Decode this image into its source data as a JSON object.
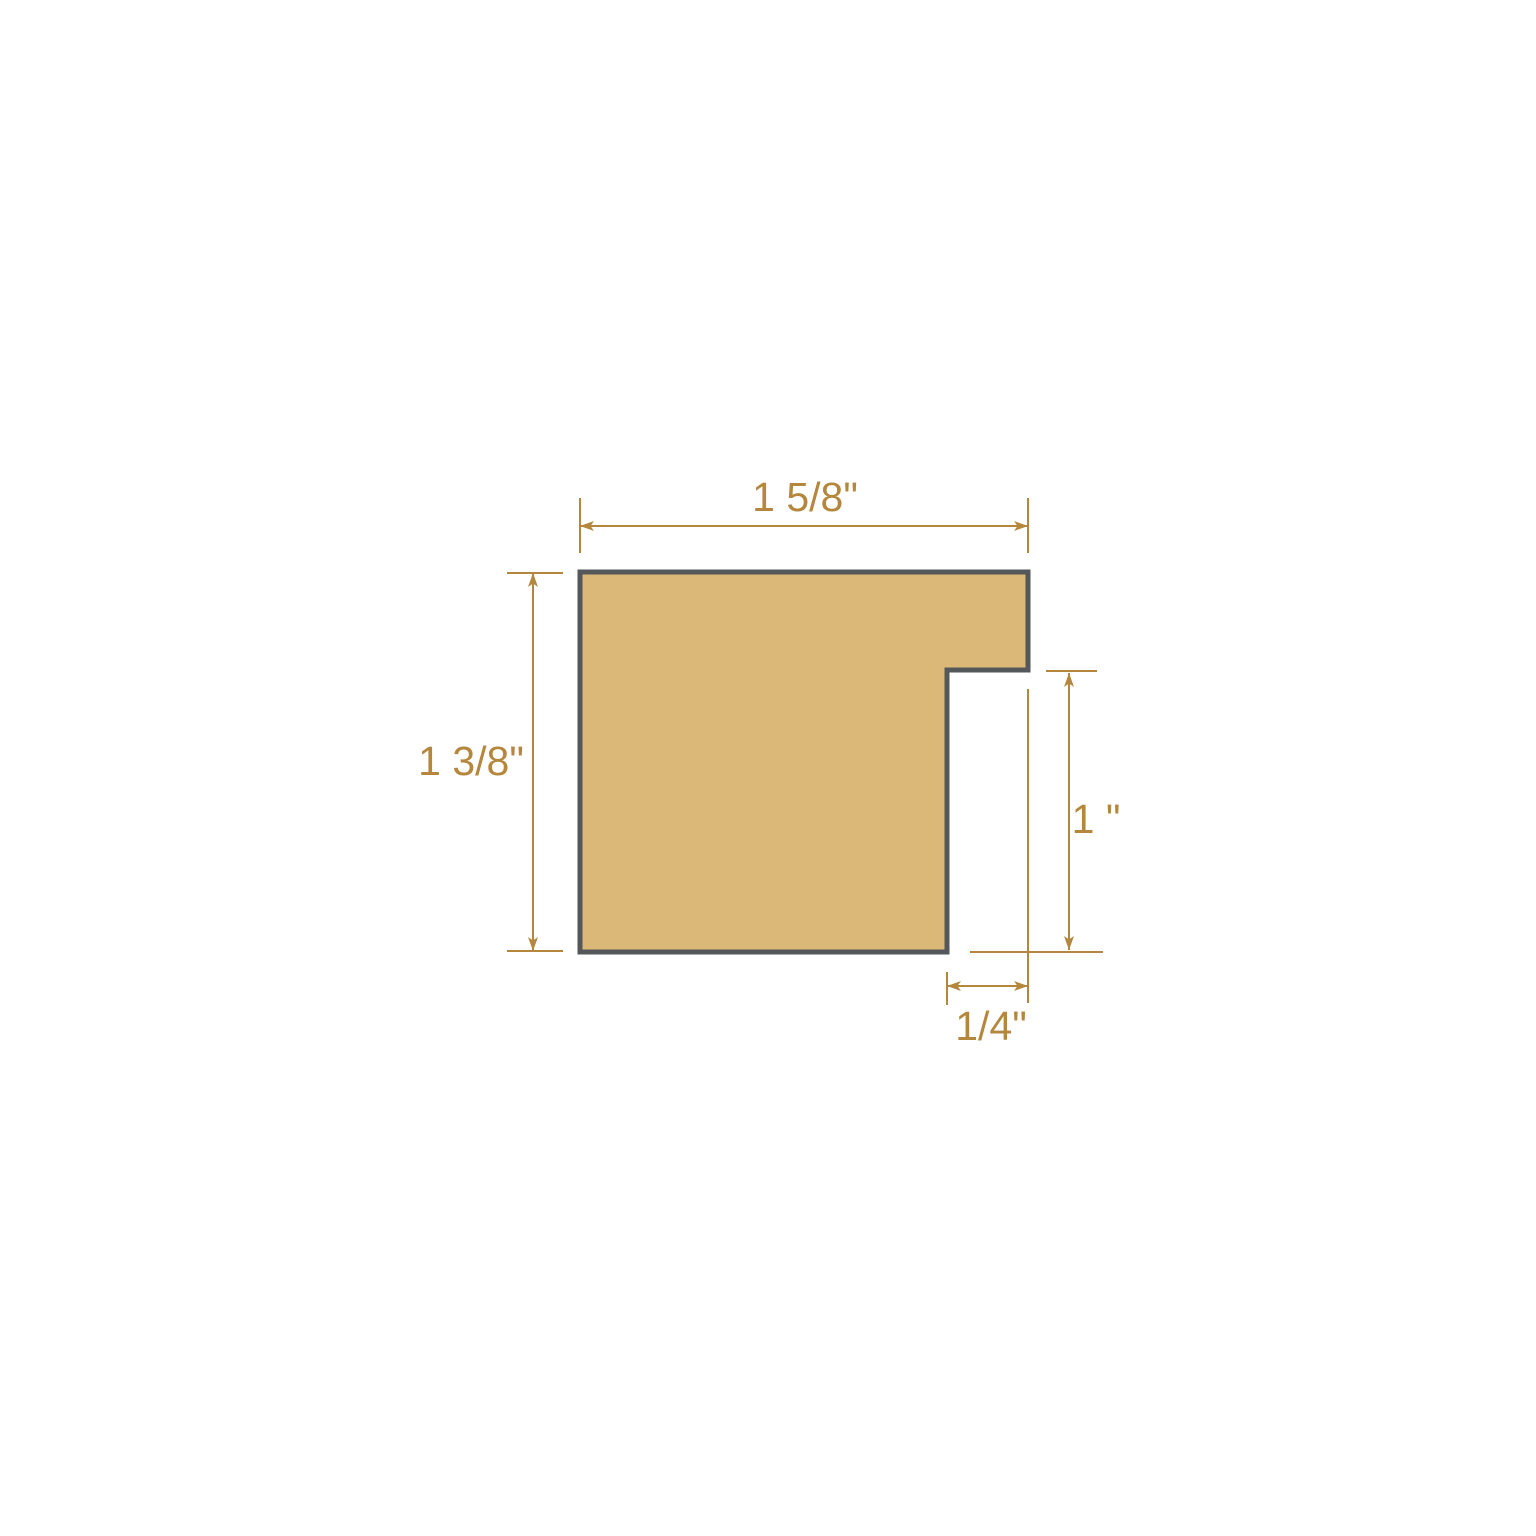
{
  "page": {
    "background": "#FFFFFF"
  },
  "diagram": {
    "shape": {
      "fill": "#DBB877",
      "outline": "#54585A"
    },
    "dimension_color": "#B5873D",
    "dimensions": {
      "top_width": {
        "label": "1 5/8\"",
        "inches": 1.625
      },
      "left_height": {
        "label": "1 3/8\"",
        "inches": 1.375
      },
      "right_rabbet_height": {
        "label": "1 \"",
        "inches": 1
      },
      "bottom_rabbet_width": {
        "label": "1/4\"",
        "inches": 0.25
      }
    }
  }
}
